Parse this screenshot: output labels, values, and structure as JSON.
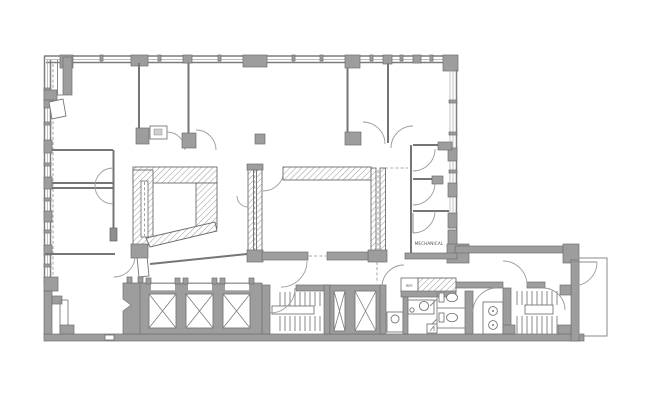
{
  "plan": {
    "labels": {
      "mechanical_room": "MECHANICAL",
      "refrigerator": "REF."
    },
    "colors": {
      "background": "#ffffff",
      "wall_fill": "#9d9d9d",
      "wall_outline": "#6f6f6f",
      "partition_line": "#767676",
      "hatch_line": "#9a9a9a",
      "door_arc": "#9d9d9d",
      "dashed_line": "#8c8c8c"
    },
    "counts": {
      "passenger_elevators": 3,
      "service_shafts": 2,
      "stairwells": 2,
      "toilets": 2,
      "lavatory_circles": 2
    }
  }
}
